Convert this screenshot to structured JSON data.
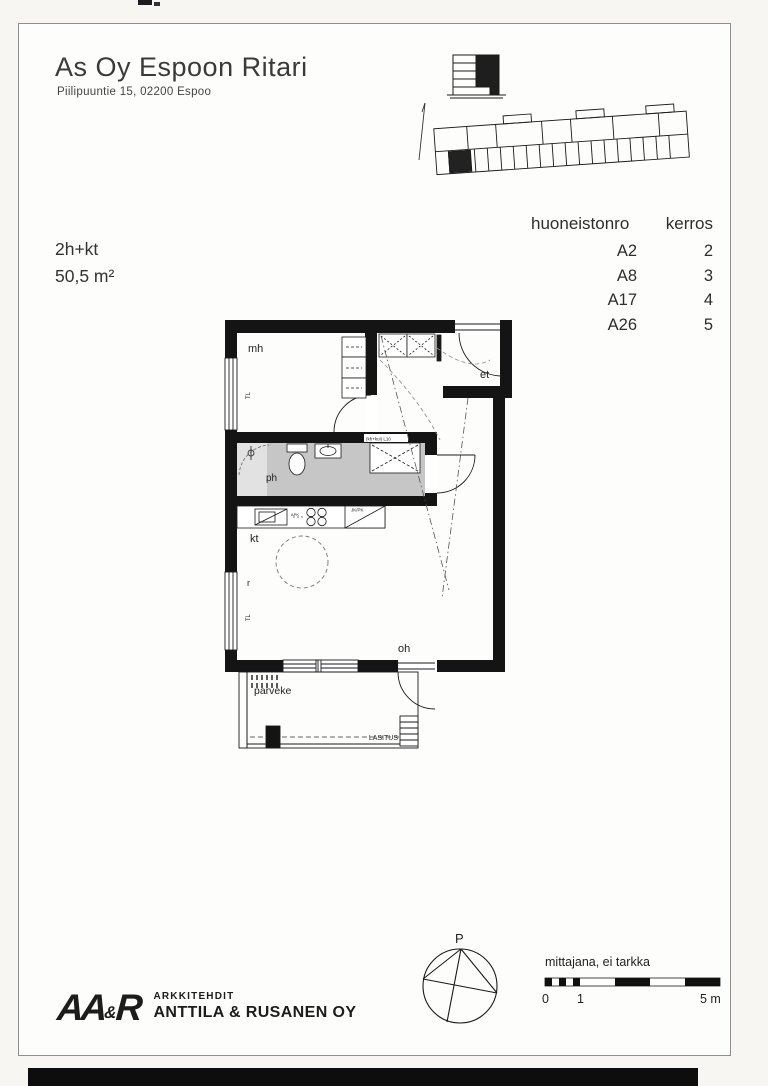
{
  "header": {
    "title": "As Oy Espoon Ritari",
    "address": "Piilipuuntie 15, 02200 Espoo"
  },
  "apartment": {
    "type": "2h+kt",
    "area": "50,5 m²"
  },
  "unit_table": {
    "col_apartment": "huoneistonro",
    "col_floor": "kerros",
    "rows": [
      {
        "apartment": "A2",
        "floor": "2"
      },
      {
        "apartment": "A8",
        "floor": "3"
      },
      {
        "apartment": "A17",
        "floor": "4"
      },
      {
        "apartment": "A26",
        "floor": "5"
      }
    ]
  },
  "floor_plan": {
    "labels": {
      "mh": "mh",
      "et": "et",
      "ph": "ph",
      "kt": "kt",
      "r": "r",
      "oh": "oh",
      "parveke": "parveke",
      "tl": "TL",
      "washer_tag": "(kh+kui) L10",
      "apk": "APK",
      "jk_pk": "JK/PK",
      "lasitus": "LASITUS"
    }
  },
  "footer": {
    "logo": {
      "aa": "AA",
      "amp": "&",
      "r": "R",
      "line1": "ARKKITEHDIT",
      "line2": "ANTTILA & RUSANEN OY"
    },
    "compass_label": "P",
    "scale": {
      "label": "mittajana, ei tarkka",
      "tick0": "0",
      "tick1": "1",
      "tick5": "5 m"
    }
  },
  "colors": {
    "wall": "#141414",
    "bath_tile": "#c6c6c6",
    "shower_tile": "#e2e2e2"
  }
}
